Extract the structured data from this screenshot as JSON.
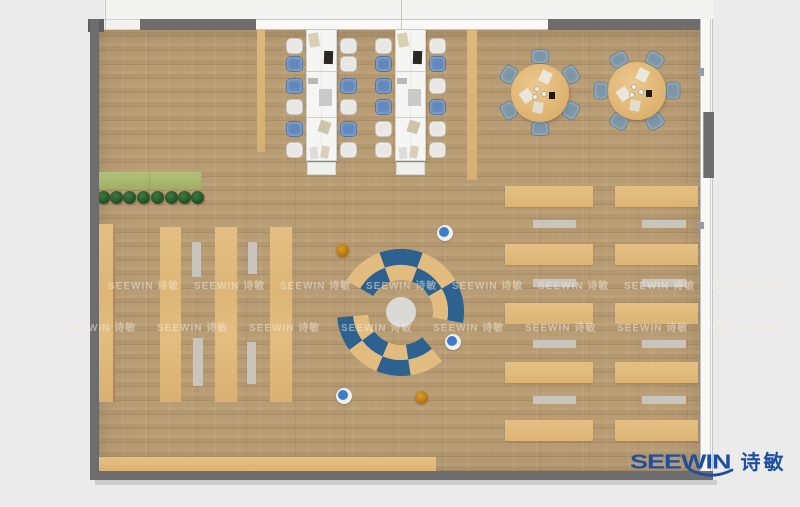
{
  "palette": {
    "outside_bg": "#ebebeb",
    "wall": "#6d6d6d",
    "floor_base": "#b49872",
    "tan": "#e0ba7c",
    "bench_gray": "#cac5bc",
    "desk_white": "#f5f5f3",
    "chair_white": "#e8e7e3",
    "chair_blue": "#6389bc",
    "round_chair_blue_gray": "#7c96a7",
    "lounge_blue": "#2d6190",
    "lounge_tan": "#e2bc7e",
    "hub_gray": "#d9d9d6",
    "stool_blue": "#3c7cc9",
    "stool_orange": "#c08119",
    "plant_green": "#2d5c30",
    "mat_green": "#aaba6e",
    "logo_blue": "#1d4fa0"
  },
  "logo": {
    "text_en": "SEEWIN",
    "text_cn": "诗敏"
  },
  "watermark": {
    "text": "SEEWIN 诗敏",
    "rows": [
      {
        "y": 277,
        "x0": 108,
        "step": 86,
        "count": 8
      },
      {
        "y": 319,
        "x0": 65,
        "step": 92,
        "count": 8
      }
    ]
  },
  "plan": {
    "desks": [
      {
        "x": 306,
        "y": 29,
        "w": 31,
        "h": 132,
        "chairs_left": [
          "white",
          "blue",
          "blue",
          "white",
          "blue",
          "white"
        ],
        "chairs_right": [
          "white",
          "white",
          "blue",
          "white",
          "blue",
          "white"
        ]
      },
      {
        "x": 395,
        "y": 29,
        "w": 31,
        "h": 132,
        "chairs_left": [
          "white",
          "blue",
          "blue",
          "blue",
          "white",
          "white"
        ],
        "chairs_right": [
          "white",
          "blue",
          "white",
          "blue",
          "white",
          "white"
        ]
      }
    ],
    "desk_chair_offsets": [
      9,
      27,
      49,
      70,
      92,
      113
    ],
    "desk_items": [
      {
        "x": 3,
        "y": 4,
        "w": 10,
        "h": 14,
        "c": "#d9cfb2",
        "rot": -10
      },
      {
        "x": 18,
        "y": 22,
        "w": 9,
        "h": 13,
        "c": "#2b2722",
        "rot": 2
      },
      {
        "x": 2,
        "y": 49,
        "w": 10,
        "h": 6,
        "c": "#bab8b3",
        "rot": 0
      },
      {
        "x": 13,
        "y": 60,
        "w": 13,
        "h": 17,
        "c": "#c9c9c6",
        "rot": 0
      },
      {
        "x": 13,
        "y": 92,
        "w": 11,
        "h": 12,
        "c": "#cdc4a9",
        "rot": 18
      },
      {
        "x": 4,
        "y": 118,
        "w": 8,
        "h": 12,
        "c": "#dcdcda",
        "rot": -6
      },
      {
        "x": 15,
        "y": 117,
        "w": 8,
        "h": 12,
        "c": "#d7d0bd",
        "rot": 10
      }
    ],
    "desk_dividers": [
      {
        "x": 257,
        "y": 30,
        "w": 8,
        "h": 122
      },
      {
        "x": 467,
        "y": 30,
        "w": 10,
        "h": 150
      }
    ],
    "round_tables": [
      {
        "cx": 540,
        "cy": 93,
        "r": 29,
        "start": 90
      },
      {
        "cx": 637,
        "cy": 91,
        "r": 29,
        "start": 60
      }
    ],
    "round_table_items": [
      {
        "dx": -14,
        "dy": 3,
        "w": 11,
        "h": 12,
        "c": "#eae6dc",
        "rot": -35
      },
      {
        "dx": 5,
        "dy": -16,
        "w": 11,
        "h": 12,
        "c": "#eae6dc",
        "rot": 25
      },
      {
        "dx": -2,
        "dy": 14,
        "w": 10,
        "h": 11,
        "c": "#e3ddd0",
        "rot": 10
      },
      {
        "dx": 12,
        "dy": 2,
        "w": 6,
        "h": 7,
        "c": "#221a10",
        "rot": 0
      },
      {
        "dx": -3,
        "dy": -4,
        "cup": true
      },
      {
        "dx": 4,
        "dy": 1,
        "cup": true
      },
      {
        "dx": -5,
        "dy": 4,
        "cup": true
      }
    ],
    "planter": {
      "mat": {
        "x": 98,
        "y": 172,
        "w": 102,
        "h": 17
      },
      "plant_y": 197,
      "plant_xs": [
        103,
        116,
        129,
        143,
        157,
        171,
        184,
        197
      ]
    },
    "left_shelves": [
      {
        "x": 98,
        "y": 224,
        "w": 15,
        "h": 178
      },
      {
        "x": 160,
        "y": 227,
        "w": 21,
        "h": 175
      },
      {
        "x": 215,
        "y": 227,
        "w": 22,
        "h": 175
      },
      {
        "x": 270,
        "y": 227,
        "w": 22,
        "h": 175
      }
    ],
    "left_benches": [
      {
        "x": 192,
        "y": 242,
        "w": 9,
        "h": 35
      },
      {
        "x": 193,
        "y": 338,
        "w": 10,
        "h": 48
      },
      {
        "x": 248,
        "y": 242,
        "w": 9,
        "h": 32
      },
      {
        "x": 247,
        "y": 342,
        "w": 9,
        "h": 42
      }
    ],
    "right_cols": [
      {
        "x": 505,
        "w": 88,
        "bx": 533,
        "bw": 43
      },
      {
        "x": 615,
        "w": 83,
        "bx": 642,
        "bw": 44
      }
    ],
    "right_table_rows": [
      186,
      244,
      303,
      362,
      420
    ],
    "right_table_h": 21,
    "right_bench_rows": [
      220,
      279,
      340,
      396
    ],
    "right_bench_h": 8,
    "bottom_bench": {
      "x": 98,
      "y": 457,
      "w": 338,
      "h": 15
    },
    "lounge": {
      "cx": 401,
      "cy": 312,
      "hub_r": 15,
      "arcs": [
        {
          "r0": 47,
          "r1": 63,
          "a1": -10,
          "a2": 150,
          "colors": [
            "#2d6190",
            "#e2bc7e",
            "#2d6190",
            "#e2bc7e"
          ]
        },
        {
          "r0": 32,
          "r1": 47,
          "a1": -10,
          "a2": 150,
          "colors": [
            "#e2bc7e",
            "#2d6190",
            "#e2bc7e",
            "#2d6190"
          ]
        },
        {
          "r0": 48,
          "r1": 64,
          "a1": 185,
          "a2": 310,
          "colors": [
            "#2d6190",
            "#e2bc7e",
            "#2d6190",
            "#e2bc7e"
          ]
        },
        {
          "r0": 33,
          "r1": 48,
          "a1": 185,
          "a2": 310,
          "colors": [
            "#e2bc7e",
            "#2d6190",
            "#e2bc7e",
            "#2d6190"
          ]
        }
      ]
    },
    "stools": [
      {
        "x": 445,
        "y": 233,
        "type": "blue"
      },
      {
        "x": 453,
        "y": 342,
        "type": "blue"
      },
      {
        "x": 344,
        "y": 396,
        "type": "blue"
      },
      {
        "x": 342,
        "y": 250,
        "type": "orange"
      },
      {
        "x": 421,
        "y": 397,
        "type": "orange"
      }
    ]
  }
}
